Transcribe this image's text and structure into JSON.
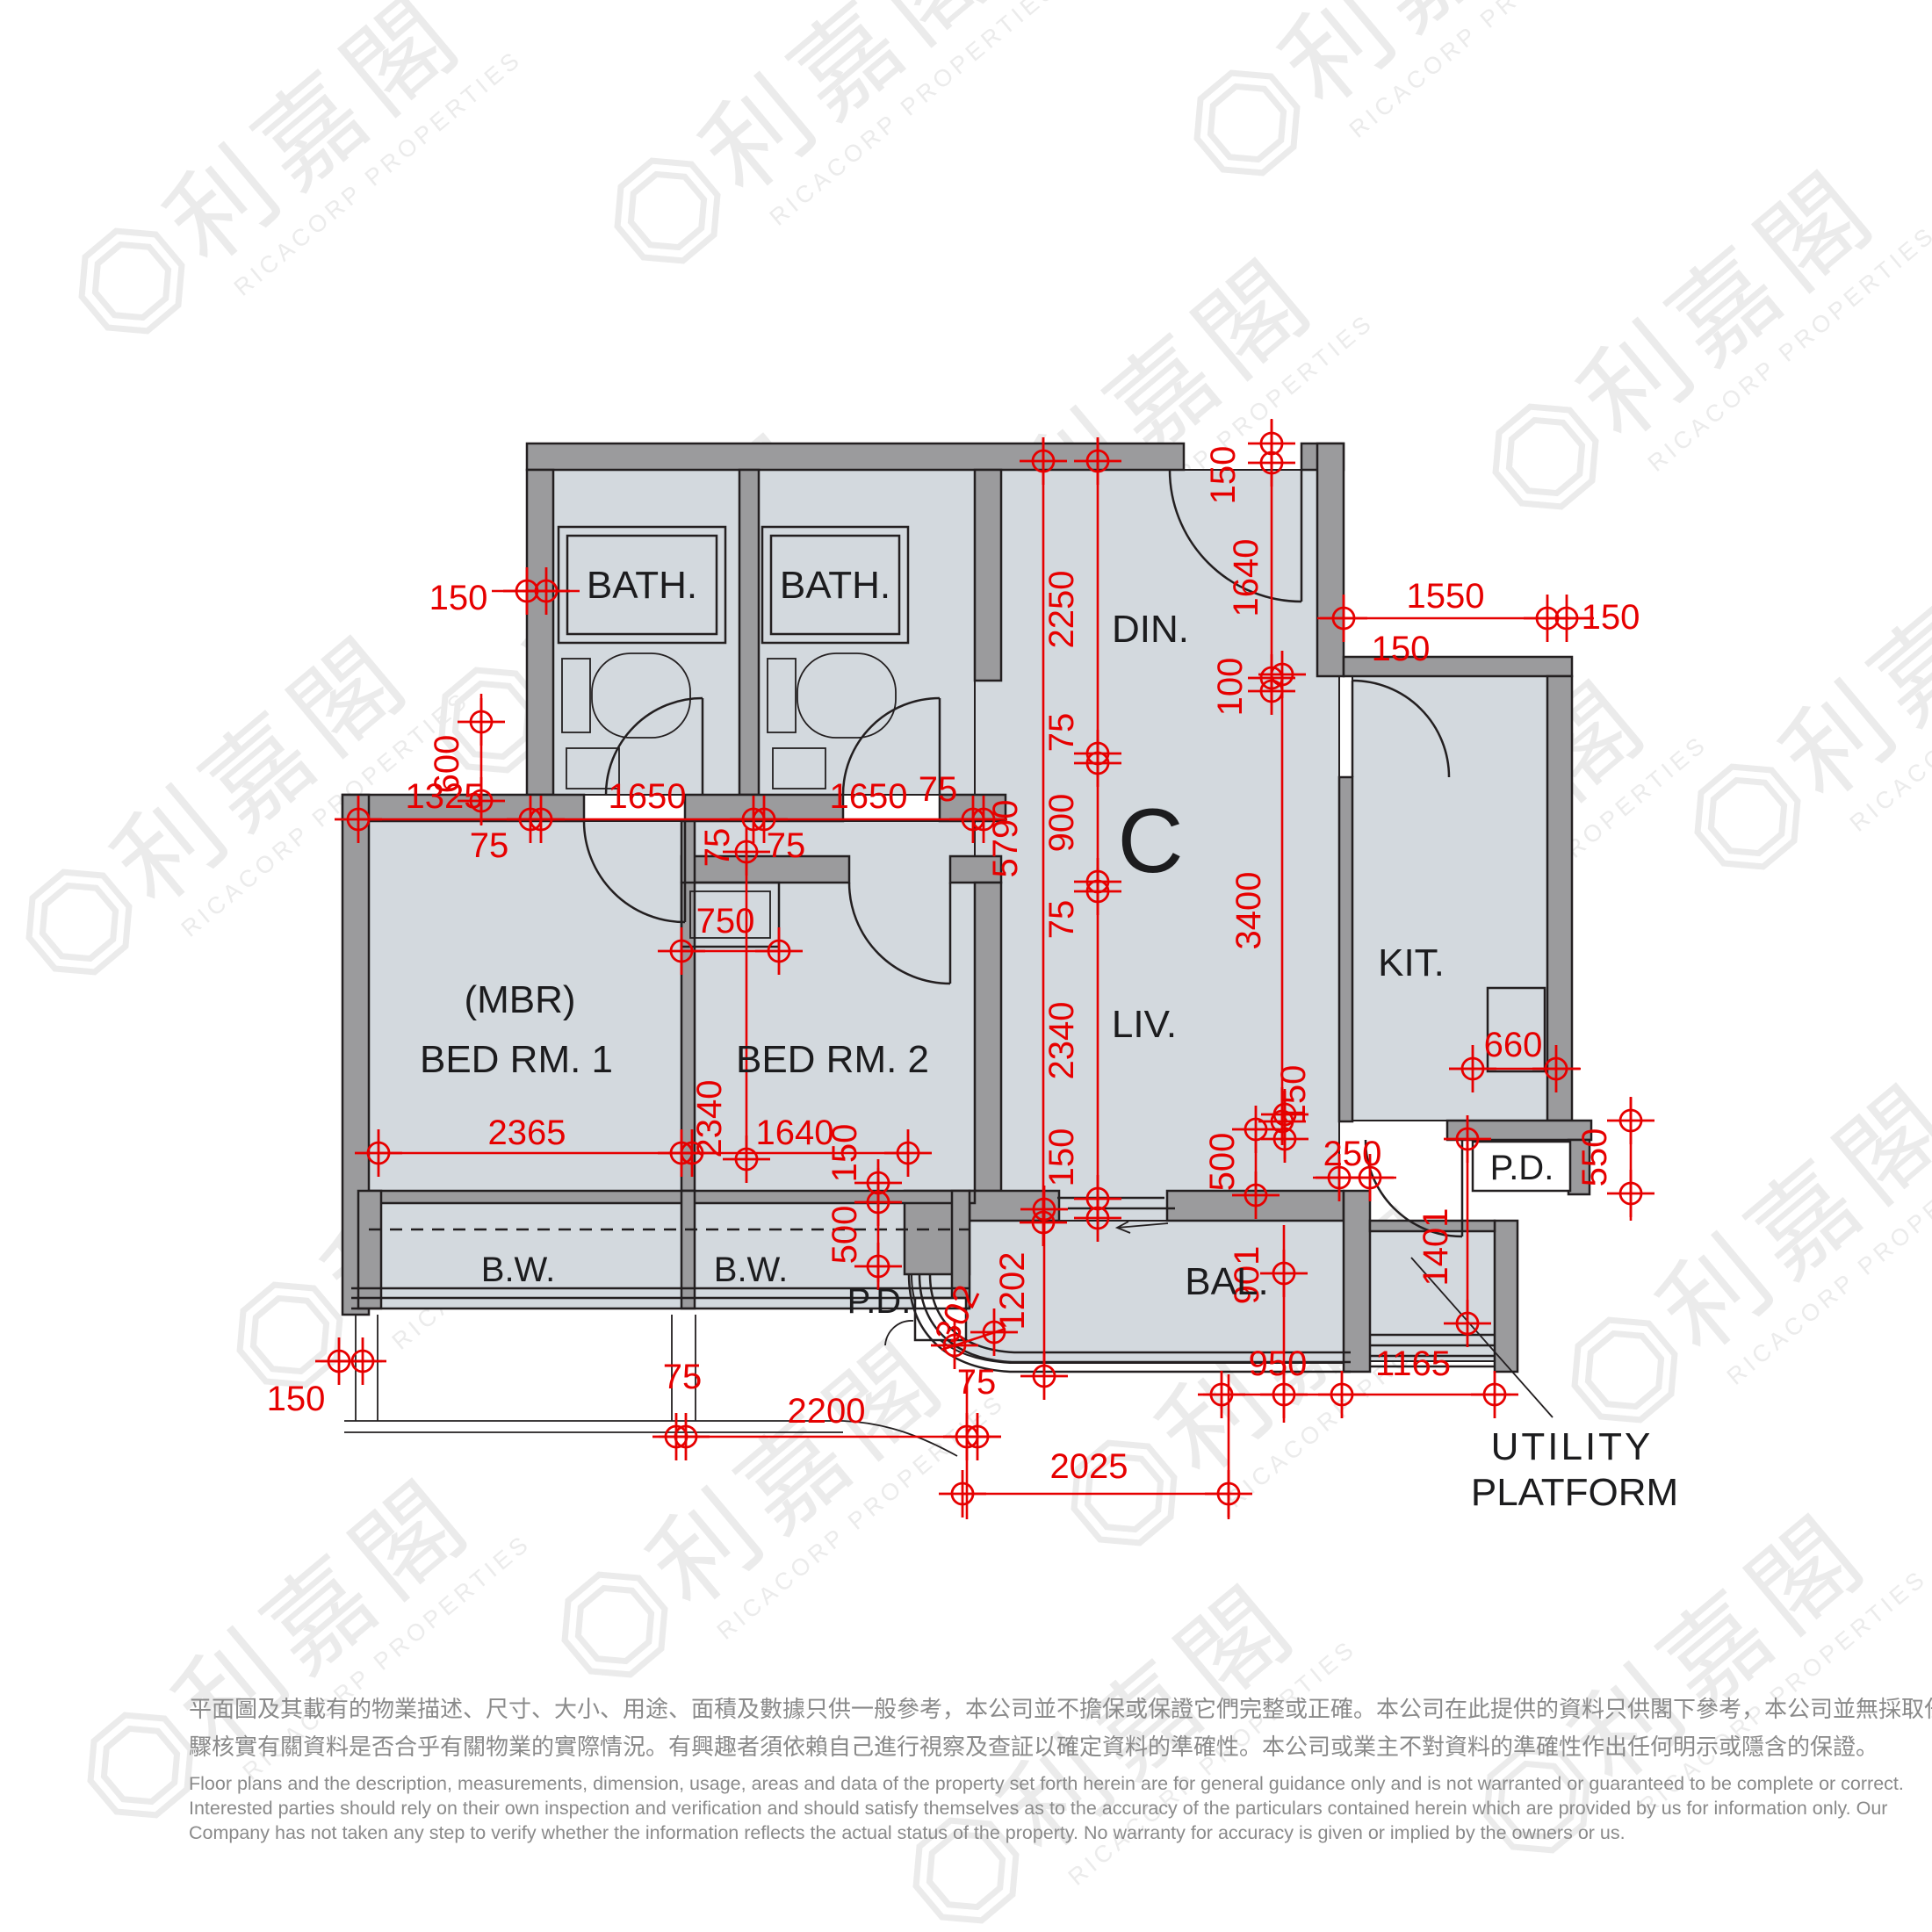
{
  "unit_label": "C",
  "rooms": {
    "bath1": "BATH.",
    "bath2": "BATH.",
    "din": "DIN.",
    "liv": "LIV.",
    "kit": "KIT.",
    "bal": "BAL.",
    "mbr_line1": "(MBR)",
    "mbr_line2": "BED RM. 1",
    "bed2": "BED RM. 2",
    "bw1": "B.W.",
    "bw2": "B.W.",
    "pd_left": "P.D.",
    "pd_right": "P.D.",
    "utility_line1": "UTILITY",
    "utility_line2": "PLATFORM"
  },
  "dims": [
    "150",
    "600",
    "1325",
    "1650",
    "1650",
    "75",
    "75",
    "75",
    "75",
    "2250",
    "75",
    "900",
    "75",
    "2340",
    "150",
    "5790",
    "150",
    "1640",
    "100",
    "1550",
    "150",
    "150",
    "3400",
    "750",
    "2340",
    "2365",
    "1640",
    "150",
    "500",
    "150",
    "250",
    "660",
    "550",
    "1401",
    "500",
    "901",
    "1202",
    "302",
    "150",
    "75",
    "2200",
    "75",
    "2025",
    "950",
    "1165"
  ],
  "watermark": {
    "cjk": "利嘉閣",
    "en": "RICACORP PROPERTIES"
  },
  "colors": {
    "dim_red": "#e60000",
    "wall_gray": "#9b9b9d",
    "room_fill": "#d3d9de",
    "line_black": "#231f20"
  },
  "disclaimer": {
    "zh1": "平面圖及其載有的物業描述、尺寸、大小、用途、面積及數據只供一般參考，本公司並不擔保或保證它們完整或正確。本公司在此提供的資料只供閣下參考，本公司並無採取任何步",
    "zh2": "驟核實有關資料是否合乎有關物業的實際情況。有興趣者須依賴自己進行視察及查証以確定資料的準確性。本公司或業主不對資料的準確性作出任何明示或隱含的保證。",
    "en1": "Floor plans and the description, measurements, dimension, usage, areas and data of the property set forth herein are for general guidance only and is not warranted or guaranteed to be complete or correct.",
    "en2": "Interested parties should rely on their own inspection and verification and should satisfy themselves as to the accuracy of the particulars contained herein which are provided by us for information only.  Our",
    "en3": "Company has not taken any step to verify whether the information reflects the actual status of the property.  No warranty for accuracy is given or implied by the owners or us."
  }
}
